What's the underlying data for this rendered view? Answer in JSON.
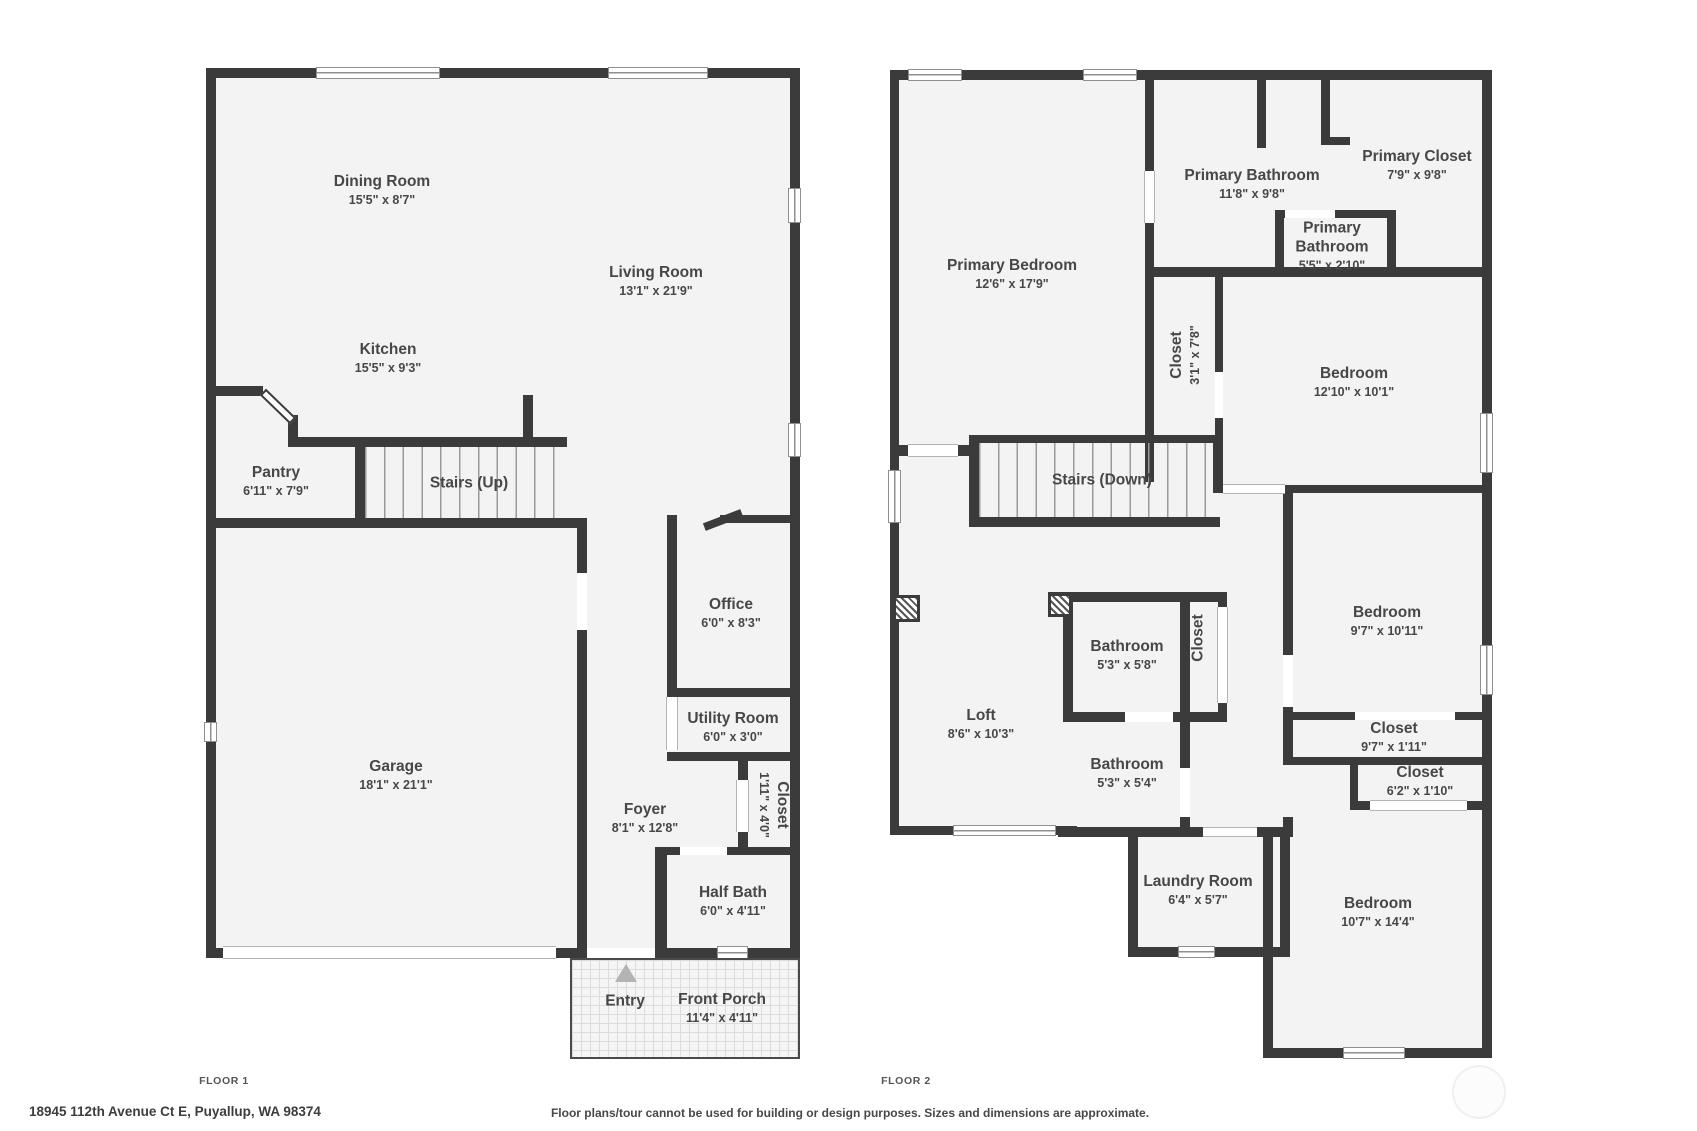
{
  "meta": {
    "floor1_label": "FLOOR 1",
    "floor2_label": "FLOOR 2",
    "address": "18945 112th Avenue Ct E, Puyallup, WA 98374",
    "disclaimer": "Floor plans/tour cannot be used for building or design purposes. Sizes and dimensions are approximate.",
    "wall_color": "#3b3b3b",
    "floor_fill_color": "#f3f3f3",
    "label_color": "#474747"
  },
  "floor1": {
    "rooms": [
      {
        "id": "dining-room",
        "name": "Dining Room",
        "dims": "15'5\" x 8'7\"",
        "cx": 382,
        "cy": 190,
        "rot": 0
      },
      {
        "id": "living-room",
        "name": "Living Room",
        "dims": "13'1\" x 21'9\"",
        "cx": 656,
        "cy": 281,
        "rot": 0
      },
      {
        "id": "kitchen",
        "name": "Kitchen",
        "dims": "15'5\" x 9'3\"",
        "cx": 388,
        "cy": 358,
        "rot": 0
      },
      {
        "id": "pantry",
        "name": "Pantry",
        "dims": "6'11\" x 7'9\"",
        "cx": 276,
        "cy": 481,
        "rot": 0
      },
      {
        "id": "stairs-up",
        "name": "Stairs (Up)",
        "dims": "",
        "cx": 469,
        "cy": 483,
        "rot": 0
      },
      {
        "id": "garage",
        "name": "Garage",
        "dims": "18'1\" x 21'1\"",
        "cx": 396,
        "cy": 775,
        "rot": 0
      },
      {
        "id": "office",
        "name": "Office",
        "dims": "6'0\" x 8'3\"",
        "cx": 731,
        "cy": 613,
        "rot": 0
      },
      {
        "id": "utility-room",
        "name": "Utility Room",
        "dims": "6'0\" x 3'0\"",
        "cx": 733,
        "cy": 727,
        "rot": 0
      },
      {
        "id": "closet-foyer",
        "name": "Closet",
        "dims": "1'11\" x 4'0\"",
        "cx": 774,
        "cy": 805,
        "rot": 90
      },
      {
        "id": "foyer",
        "name": "Foyer",
        "dims": "8'1\" x 12'8\"",
        "cx": 645,
        "cy": 818,
        "rot": 0
      },
      {
        "id": "half-bath",
        "name": "Half Bath",
        "dims": "6'0\" x 4'11\"",
        "cx": 733,
        "cy": 901,
        "rot": 0
      },
      {
        "id": "entry",
        "name": "Entry",
        "dims": "",
        "cx": 625,
        "cy": 1001,
        "rot": 0
      },
      {
        "id": "front-porch",
        "name": "Front Porch",
        "dims": "11'4\" x 4'11\"",
        "cx": 722,
        "cy": 1008,
        "rot": 0
      }
    ]
  },
  "floor2": {
    "rooms": [
      {
        "id": "primary-bedroom",
        "name": "Primary Bedroom",
        "dims": "12'6\" x 17'9\"",
        "cx": 1012,
        "cy": 274,
        "rot": 0
      },
      {
        "id": "primary-bathroom",
        "name": "Primary Bathroom",
        "dims": "11'8\" x 9'8\"",
        "cx": 1252,
        "cy": 184,
        "rot": 0
      },
      {
        "id": "primary-closet",
        "name": "Primary Closet",
        "dims": "7'9\" x 9'8\"",
        "cx": 1417,
        "cy": 165,
        "rot": 0
      },
      {
        "id": "primary-bathroom-wc",
        "name": "Primary\nBathroom",
        "dims": "5'5\" x 2'10\"",
        "cx": 1332,
        "cy": 246,
        "rot": 0
      },
      {
        "id": "closet-primary-bedroom",
        "name": "Closet",
        "dims": "3'1\" x 7'8\"",
        "cx": 1185,
        "cy": 355,
        "rot": -90
      },
      {
        "id": "bedroom-2",
        "name": "Bedroom",
        "dims": "12'10\" x 10'1\"",
        "cx": 1354,
        "cy": 382,
        "rot": 0
      },
      {
        "id": "stairs-down",
        "name": "Stairs (Down)",
        "dims": "",
        "cx": 1102,
        "cy": 480,
        "rot": 0
      },
      {
        "id": "loft",
        "name": "Loft",
        "dims": "8'6\" x 10'3\"",
        "cx": 981,
        "cy": 724,
        "rot": 0
      },
      {
        "id": "bathroom-hall",
        "name": "Bathroom",
        "dims": "5'3\" x 5'8\"",
        "cx": 1127,
        "cy": 655,
        "rot": 0
      },
      {
        "id": "closet-hall",
        "name": "Closet",
        "dims": "",
        "cx": 1198,
        "cy": 638,
        "rot": -90
      },
      {
        "id": "bathroom-2",
        "name": "Bathroom",
        "dims": "5'3\" x 5'4\"",
        "cx": 1127,
        "cy": 773,
        "rot": 0
      },
      {
        "id": "bedroom-3",
        "name": "Bedroom",
        "dims": "9'7\" x 10'11\"",
        "cx": 1387,
        "cy": 621,
        "rot": 0
      },
      {
        "id": "closet-bedroom-3",
        "name": "Closet",
        "dims": "9'7\" x 1'11\"",
        "cx": 1394,
        "cy": 737,
        "rot": 0
      },
      {
        "id": "closet-bedroom-4",
        "name": "Closet",
        "dims": "6'2\" x 1'10\"",
        "cx": 1420,
        "cy": 781,
        "rot": 0
      },
      {
        "id": "laundry-room",
        "name": "Laundry Room",
        "dims": "6'4\" x 5'7\"",
        "cx": 1198,
        "cy": 890,
        "rot": 0
      },
      {
        "id": "bedroom-4",
        "name": "Bedroom",
        "dims": "10'7\" x 14'4\"",
        "cx": 1378,
        "cy": 912,
        "rot": 0
      }
    ]
  },
  "geometry": {
    "fills": [
      [
        206,
        68,
        800,
        958
      ],
      [
        890,
        70,
        1492,
        835
      ],
      [
        1128,
        835,
        1290,
        957
      ],
      [
        1273,
        835,
        1492,
        1058
      ]
    ],
    "walls": [
      [
        206,
        68,
        800,
        78
      ],
      [
        206,
        68,
        216,
        958
      ],
      [
        790,
        68,
        800,
        958
      ],
      [
        206,
        948,
        800,
        958
      ],
      [
        216,
        386,
        263,
        396
      ],
      [
        288,
        415,
        298,
        447
      ],
      [
        288,
        437,
        567,
        447
      ],
      [
        523,
        395,
        533,
        445
      ],
      [
        355,
        447,
        365,
        518
      ],
      [
        206,
        518,
        587,
        528
      ],
      [
        577,
        518,
        587,
        948
      ],
      [
        720,
        515,
        790,
        523
      ],
      [
        667,
        515,
        677,
        697
      ],
      [
        667,
        688,
        800,
        697
      ],
      [
        667,
        752,
        800,
        761
      ],
      [
        738,
        752,
        748,
        855
      ],
      [
        667,
        847,
        680,
        855
      ],
      [
        727,
        847,
        800,
        855
      ],
      [
        655,
        847,
        667,
        948
      ],
      [
        890,
        70,
        1492,
        80
      ],
      [
        890,
        70,
        899,
        835
      ],
      [
        1482,
        70,
        1492,
        1058
      ],
      [
        890,
        826,
        1077,
        835
      ],
      [
        1058,
        827,
        1203,
        837
      ],
      [
        1257,
        827,
        1283,
        837
      ],
      [
        1128,
        830,
        1138,
        957
      ],
      [
        1128,
        947,
        1290,
        957
      ],
      [
        1263,
        837,
        1273,
        957
      ],
      [
        1280,
        828,
        1290,
        957
      ],
      [
        1263,
        947,
        1273,
        1058
      ],
      [
        1263,
        1048,
        1492,
        1058
      ],
      [
        1145,
        80,
        1154,
        482
      ],
      [
        890,
        445,
        978,
        456
      ],
      [
        969,
        435,
        979,
        527
      ],
      [
        969,
        435,
        1220,
        443
      ],
      [
        969,
        517,
        1220,
        527
      ],
      [
        1213,
        435,
        1223,
        493
      ],
      [
        1154,
        267,
        1492,
        277
      ],
      [
        1215,
        267,
        1223,
        435
      ],
      [
        1257,
        80,
        1266,
        148
      ],
      [
        1321,
        80,
        1330,
        145
      ],
      [
        1330,
        137,
        1350,
        145
      ],
      [
        1275,
        210,
        1284,
        275
      ],
      [
        1275,
        210,
        1285,
        218
      ],
      [
        1335,
        210,
        1396,
        218
      ],
      [
        1387,
        210,
        1396,
        275
      ],
      [
        1048,
        592,
        1227,
        602
      ],
      [
        1063,
        592,
        1073,
        722
      ],
      [
        1180,
        602,
        1190,
        712
      ],
      [
        1218,
        602,
        1227,
        607
      ],
      [
        1218,
        703,
        1227,
        712
      ],
      [
        1063,
        712,
        1125,
        722
      ],
      [
        1173,
        712,
        1227,
        722
      ],
      [
        1180,
        722,
        1190,
        768
      ],
      [
        1180,
        817,
        1190,
        832
      ],
      [
        1283,
        485,
        1293,
        655
      ],
      [
        1283,
        707,
        1293,
        760
      ],
      [
        1283,
        817,
        1293,
        837
      ],
      [
        1283,
        485,
        1492,
        493
      ],
      [
        1283,
        712,
        1355,
        720
      ],
      [
        1455,
        712,
        1492,
        720
      ],
      [
        1283,
        757,
        1492,
        765
      ],
      [
        1350,
        765,
        1358,
        810
      ],
      [
        1350,
        801,
        1370,
        810
      ],
      [
        1467,
        801,
        1492,
        810
      ]
    ],
    "stairs": [
      [
        365,
        447,
        567,
        518
      ],
      [
        979,
        443,
        1213,
        517
      ]
    ],
    "windows": [
      {
        "r": [
          316,
          67,
          440,
          79
        ],
        "t": "win-h"
      },
      {
        "r": [
          608,
          67,
          708,
          79
        ],
        "t": "win-h"
      },
      {
        "r": [
          788,
          188,
          801,
          223
        ],
        "t": "win-v"
      },
      {
        "r": [
          788,
          423,
          801,
          457
        ],
        "t": "win-v"
      },
      {
        "r": [
          204,
          722,
          217,
          742
        ],
        "t": "win-v"
      },
      {
        "r": [
          223,
          946,
          556,
          959
        ],
        "t": "open-h"
      },
      {
        "r": [
          587,
          948,
          655,
          958
        ],
        "t": "gap"
      },
      {
        "r": [
          717,
          946,
          748,
          959
        ],
        "t": "win-h"
      },
      {
        "r": [
          577,
          573,
          587,
          630
        ],
        "t": "gap"
      },
      {
        "r": [
          666,
          697,
          678,
          750
        ],
        "t": "open-v"
      },
      {
        "r": [
          736,
          780,
          749,
          832
        ],
        "t": "open-v"
      },
      {
        "r": [
          680,
          847,
          727,
          855
        ],
        "t": "gap"
      },
      {
        "r": [
          908,
          69,
          962,
          81
        ],
        "t": "win-h"
      },
      {
        "r": [
          1083,
          69,
          1137,
          81
        ],
        "t": "win-h"
      },
      {
        "r": [
          888,
          470,
          901,
          523
        ],
        "t": "win-v"
      },
      {
        "r": [
          1480,
          413,
          1493,
          473
        ],
        "t": "win-v"
      },
      {
        "r": [
          1480,
          645,
          1493,
          695
        ],
        "t": "win-v"
      },
      {
        "r": [
          953,
          825,
          1056,
          836
        ],
        "t": "win-h"
      },
      {
        "r": [
          1178,
          946,
          1215,
          958
        ],
        "t": "win-h"
      },
      {
        "r": [
          1343,
          1047,
          1405,
          1059
        ],
        "t": "win-h"
      },
      {
        "r": [
          908,
          444,
          958,
          457
        ],
        "t": "open-h"
      },
      {
        "r": [
          1144,
          171,
          1155,
          223
        ],
        "t": "open-v"
      },
      {
        "r": [
          1223,
          484,
          1285,
          494
        ],
        "t": "open-h"
      },
      {
        "r": [
          1215,
          372,
          1223,
          418
        ],
        "t": "gap"
      },
      {
        "r": [
          1285,
          210,
          1335,
          218
        ],
        "t": "gap"
      },
      {
        "r": [
          1217,
          607,
          1228,
          703
        ],
        "t": "open-v"
      },
      {
        "r": [
          1125,
          712,
          1173,
          722
        ],
        "t": "gap"
      },
      {
        "r": [
          1180,
          768,
          1190,
          817
        ],
        "t": "gap"
      },
      {
        "r": [
          1283,
          655,
          1293,
          707
        ],
        "t": "gap"
      },
      {
        "r": [
          1355,
          712,
          1455,
          720
        ],
        "t": "gap"
      },
      {
        "r": [
          1370,
          800,
          1467,
          811
        ],
        "t": "open-h"
      },
      {
        "r": [
          1203,
          827,
          1257,
          837
        ],
        "t": "open-h"
      }
    ],
    "hatches": [
      [
        893,
        595,
        920,
        622
      ],
      [
        1048,
        593,
        1072,
        617
      ]
    ],
    "diagonals": [
      {
        "cx": 278,
        "cy": 406,
        "w": 42,
        "h": 9,
        "rot": 44,
        "style": "diag-leaf",
        "name": "kitchen-pantry-door"
      },
      {
        "cx": 723,
        "cy": 520,
        "w": 40,
        "h": 8,
        "rot": -21,
        "style": "diag-dark",
        "name": "office-door"
      }
    ],
    "porch": [
      570,
      958,
      800,
      1059
    ],
    "entry_triangle": {
      "x": 615,
      "y": 964
    },
    "watermark_circle": [
      1452,
      1065,
      1502,
      1115
    ]
  },
  "footer": {
    "floor1_x": 224,
    "floor1_y": 1075,
    "floor2_x": 906,
    "floor2_y": 1075,
    "address_x": 29,
    "address_y": 1104,
    "disclaimer_x": 850,
    "disclaimer_y": 1106
  }
}
